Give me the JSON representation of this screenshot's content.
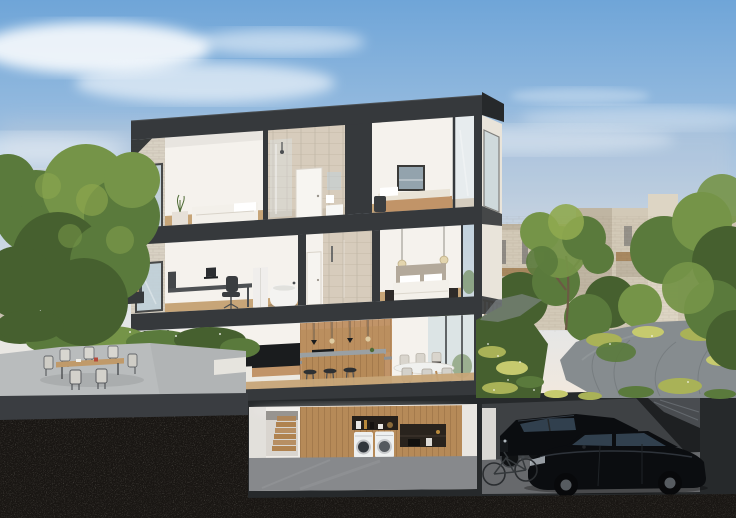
{
  "meta": {
    "type": "architectural-cross-section-render",
    "description": "Dusk daylight cutaway rendering of a four-level townhouse showing furnished interiors, with garden, terrace, neighbouring brick buildings and soil cross-section",
    "width_px": 736,
    "height_px": 518
  },
  "palette": {
    "skyTop": "#6fa5d8",
    "skyMid": "#a9c6e2",
    "skyLow": "#e2e6e8",
    "skyHorizon": "#f2e8dd",
    "cloud": "#ffffff",
    "cloudPink": "#f3ddd1",
    "treeDark": "#46602f",
    "treeMid": "#5a7a3c",
    "treeLight": "#759448",
    "treeBright": "#8fa94f",
    "grass": "#a9b257",
    "grassLight": "#c6ca6e",
    "bgBuilding": "#d2c9b7",
    "bgBuildingShade": "#bfb5a2",
    "bgBuildingLight": "#ddd5c4",
    "balconyWood": "#a8885f",
    "frame": "#36393c",
    "frameDark": "#26292b",
    "wall": "#f5f2ed",
    "wallShade": "#e6e0d8",
    "brick": "#d8d1c3",
    "tile": "#d7ccbc",
    "tileShade": "#cabfae",
    "glass": "#bfd2dc",
    "glassLight": "#dde8ee",
    "woodFloor": "#c7a578",
    "woodCabinet": "#c19468",
    "woodPanel": "#b68a58",
    "stairWood": "#b08350",
    "islandTop": "#9aa0a3",
    "counter": "#8c9194",
    "tv": "#1a1c1e",
    "deskGrey": "#4e5154",
    "chairDark": "#3a3d40",
    "sofa": "#ece9e2",
    "bedWhite": "#f3f0ea",
    "headboard": "#b3a99b",
    "cushion": "#e9e3d6",
    "appliance": "#eef0f0",
    "tub": "#f4f3f1",
    "patio": "#b9bcbd",
    "fascia": "#3a3d41",
    "soil": "#191613",
    "stone": "#868c8f",
    "stoneDark": "#6f7578",
    "garageWall": "#3e4144",
    "garageFloor": "#67696c",
    "garageDark": "#1e2022",
    "car": "#0b0d10",
    "carGlass": "#31404e",
    "rim": "#565b60",
    "metal": "#4b4e51",
    "art": "#93a3ad",
    "plant": "#4e6b35",
    "pendant": "#e2d2a8"
  },
  "scene": {
    "sky": {
      "condition": "soft clouds, pink haze near horizon"
    },
    "building": {
      "style": "modern flat-roof townhouse, dark charcoal frame, light brick facade, cut open at front plane",
      "floors": [
        {
          "level": "top floor",
          "rooms": [
            "bedroom with white bed and side table",
            "tiled bathroom with shower, door and vanity",
            "guest room with wall art and daybed"
          ]
        },
        {
          "level": "middle floor",
          "rooms": [
            "home office with desk, laptop and chair",
            "white cabinet and freestanding bathtub",
            "tiled bathroom with door",
            "master bedroom with bed, pendant lights and nightstands"
          ]
        },
        {
          "level": "ground floor",
          "rooms": [
            "living room with TV, sideboard, white sofa, plant",
            "kitchen with wood cabinetry, ovens, island, bar stools, pendants",
            "dining area with table and chairs by glass doors"
          ]
        },
        {
          "level": "basement",
          "rooms": [
            "laundry with wooden staircase, wood wall, shelf niches, washer and dryer",
            "garage with two black sedans, motorcycle and bicycle"
          ]
        }
      ],
      "exterior": [
        "left balcony with wood slats",
        "right side facade with windows and balcony slats"
      ]
    },
    "surroundings": [
      "large green tree on the left",
      "outdoor terrace with wooden dining table and six chairs on grey patio",
      "shrub beds with white flowers",
      "right garden with ornamental grasses and winding stone path",
      "neighbouring light-brick buildings with wood balconies among trees",
      "dark excavated soil cross-section along the bottom"
    ]
  }
}
